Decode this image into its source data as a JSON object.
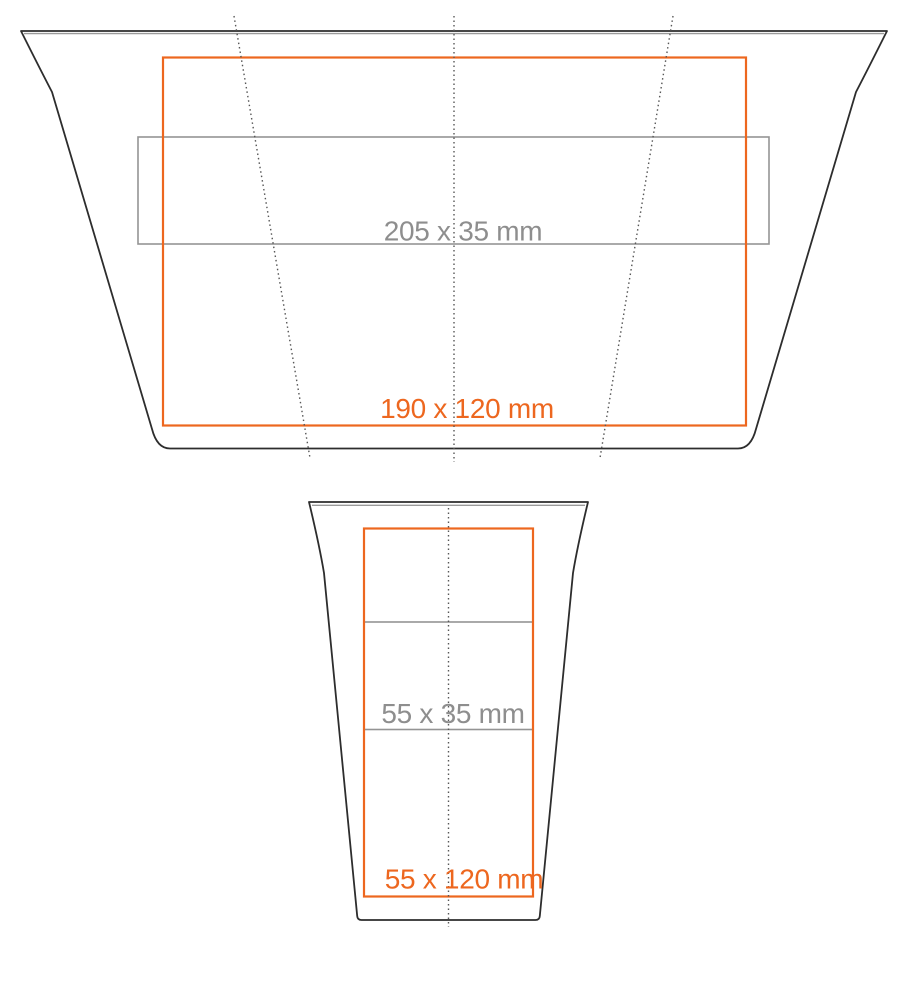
{
  "top_view": {
    "print_label": "190 x 120 mm",
    "strip_label": "205 x 35 mm"
  },
  "front_view": {
    "print_label": "55 x 120 mm",
    "strip_label": "55 x 35 mm"
  },
  "colors": {
    "outline": "#2d2d2d",
    "rim_shadow": "#9a9a9a",
    "print_area": "#ed671f",
    "strip": "#949494",
    "strip_text": "#8e8e8e",
    "centerline": "#575757",
    "background": "#ffffff"
  }
}
